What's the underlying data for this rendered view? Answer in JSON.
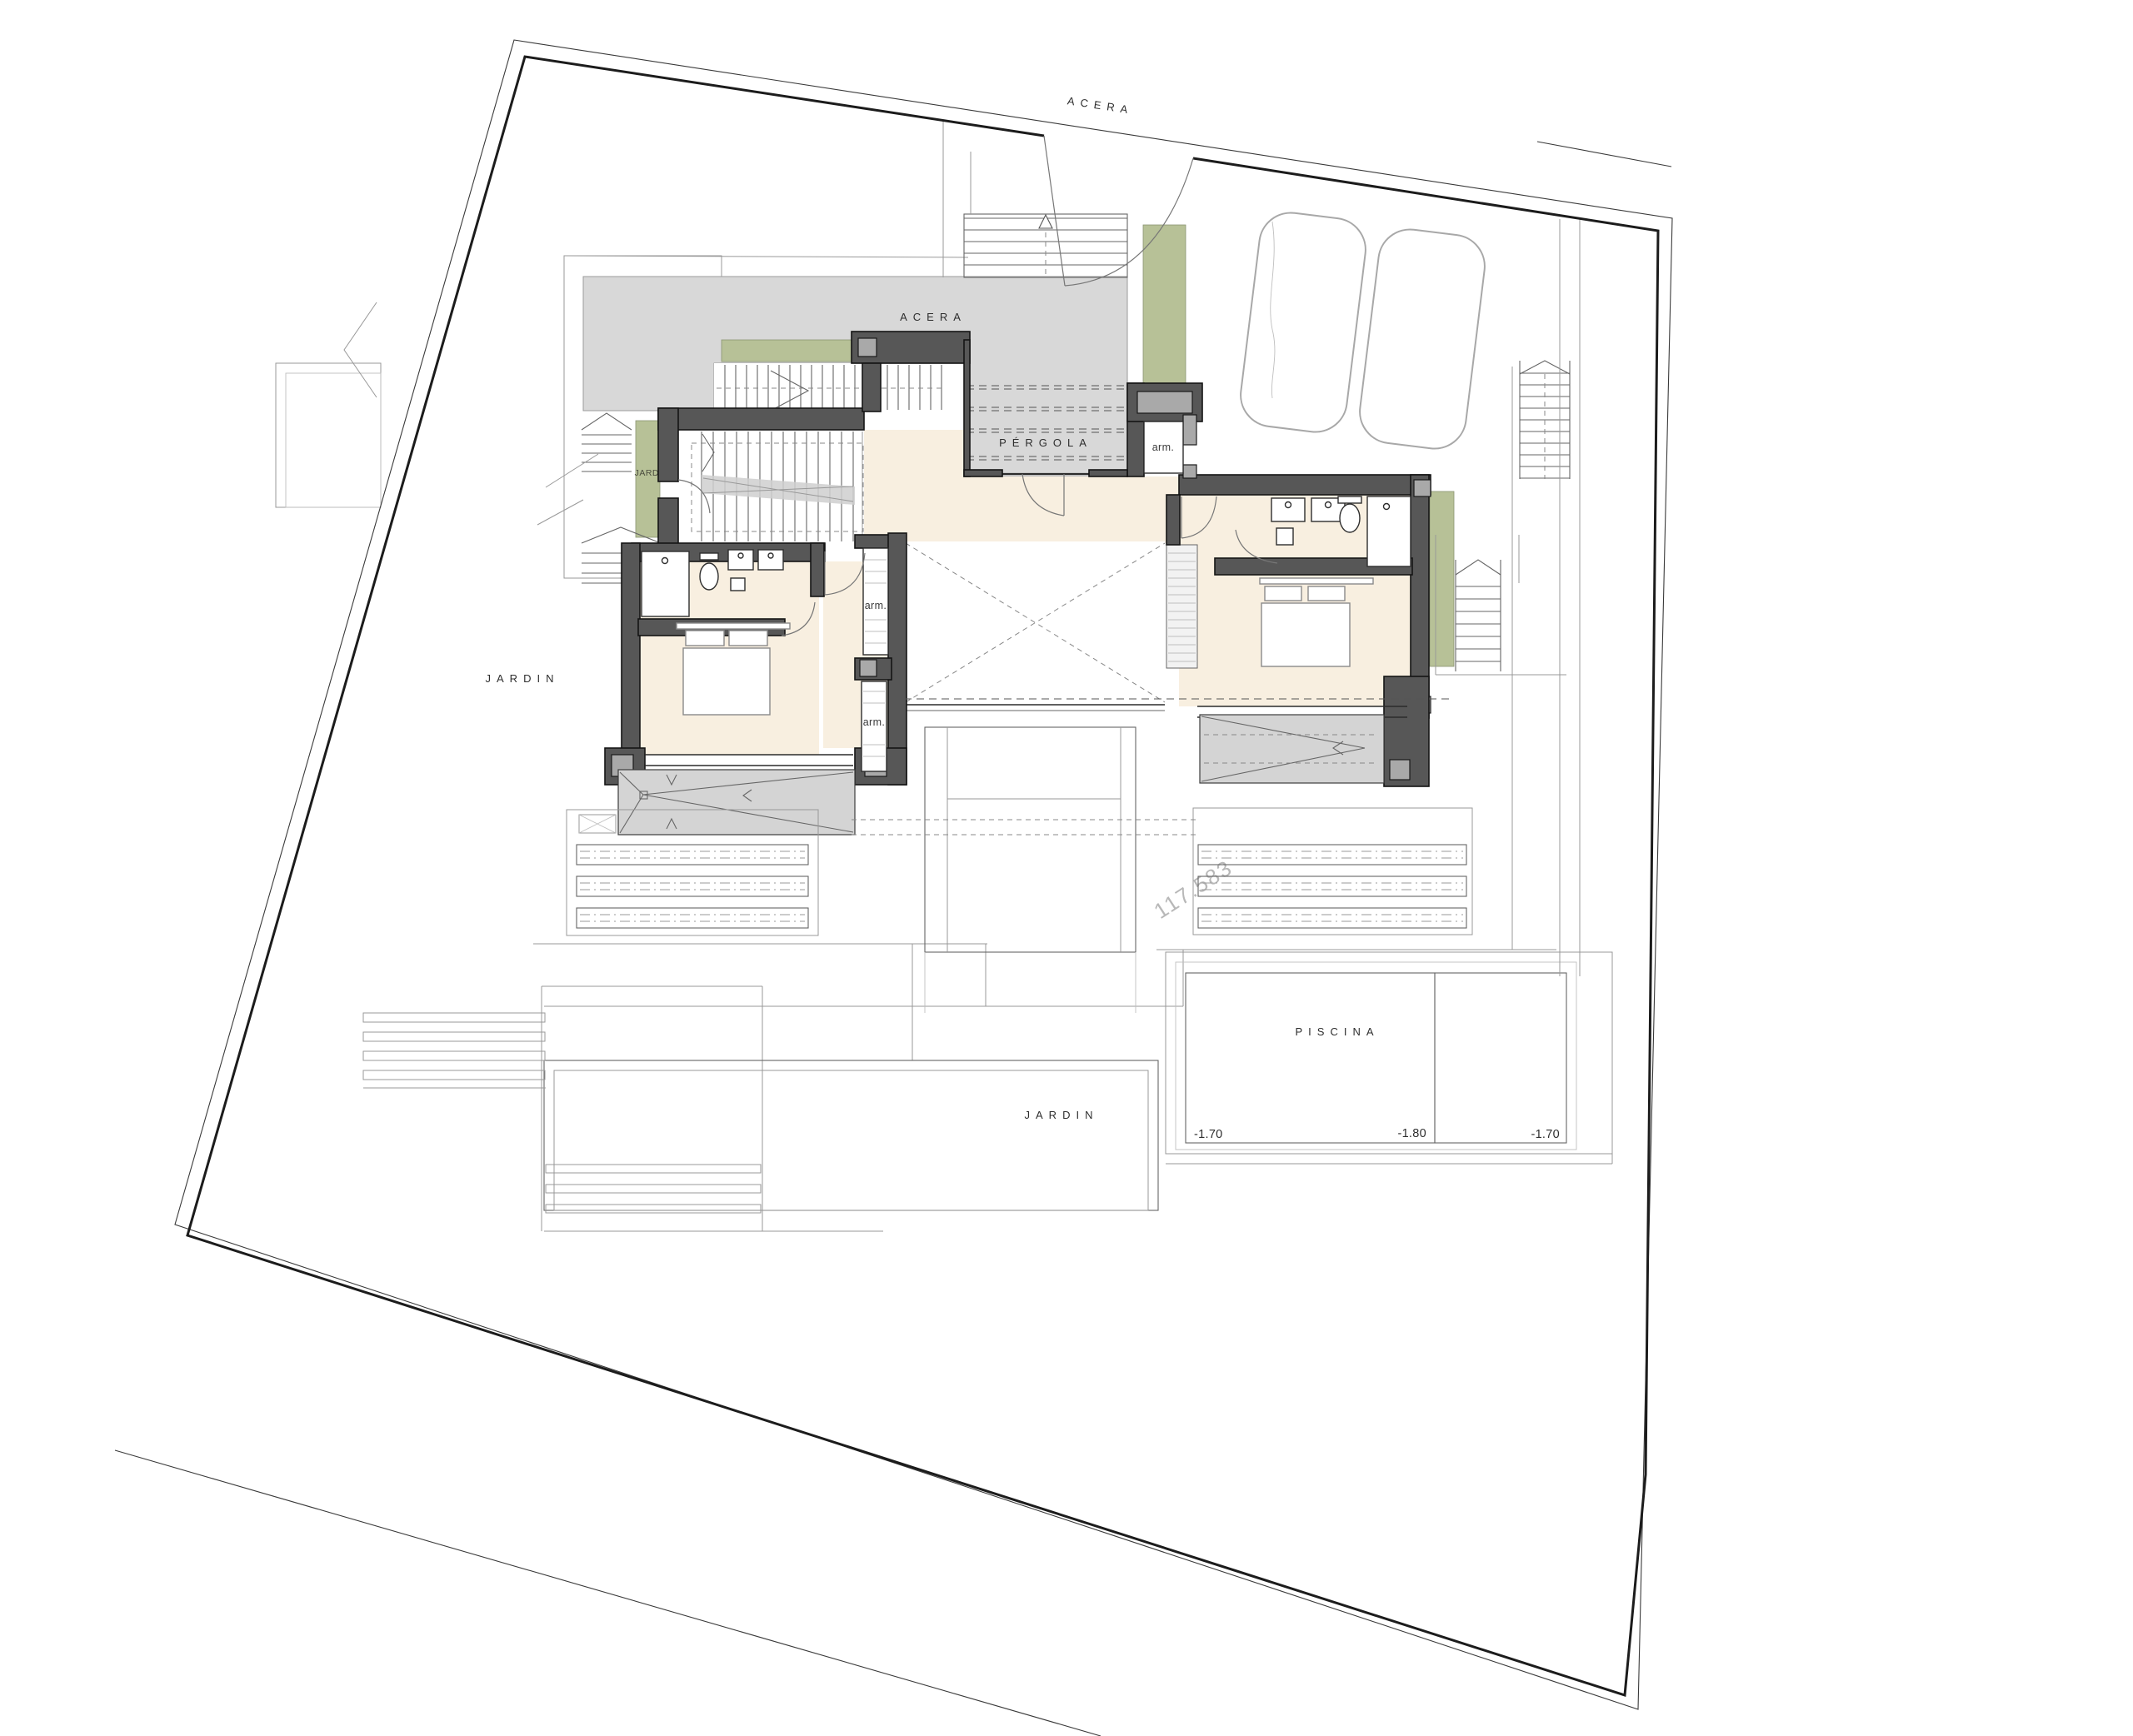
{
  "drawing": {
    "type": "architectural-site-floor-plan",
    "labels": {
      "street_top": "ACERA",
      "sidewalk": "ACERA",
      "pergola": "PÉRGOLA",
      "jard_strip": "JARD.",
      "jardin_west": "JARDIN",
      "jardin_south": "JARDIN",
      "piscina": "PISCINA",
      "arm_entry": "arm.",
      "arm_closet_1": "arm.",
      "arm_closet_2": "arm.",
      "pool_depth_left": "-1.70",
      "pool_depth_center": "-1.80",
      "pool_depth_right": "-1.70",
      "watermark": "117.583"
    },
    "colors": {
      "wall": "#575757",
      "wall_light": "#a9a9a9",
      "paving": "#d8d8d8",
      "terrace": "#d4d4d4",
      "floor": "#f8efe0",
      "planting": "#b7c197",
      "watermark": "#b8b8b8"
    }
  }
}
